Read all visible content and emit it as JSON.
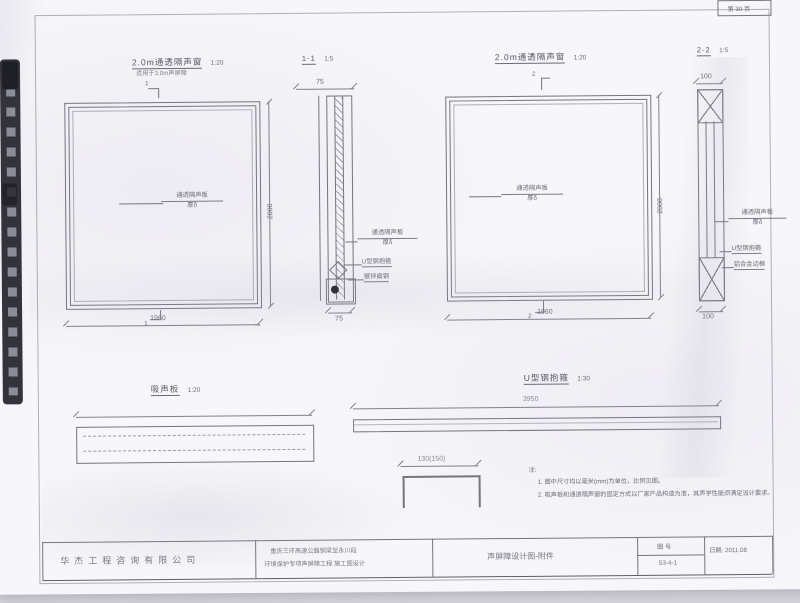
{
  "page": {
    "corner_label": "第 30 页"
  },
  "views": {
    "window_a": {
      "title": "2.0m通透隔声窗",
      "scale": "1:20",
      "subtitle": "适用于3.0m声屏障",
      "panel_label": "通透隔声板",
      "panel_thickness": "厚δ",
      "dim_width": "1960",
      "dim_height": "2000",
      "section_mark": "1"
    },
    "section_1_1": {
      "title": "1-1",
      "scale": "1:5",
      "dim_top": "75",
      "dim_bottom": "75",
      "labels": {
        "panel": "通透隔声板",
        "thickness": "厚δ",
        "clamp": "U型钢抱箍",
        "flat_steel": "镀锌扁钢"
      }
    },
    "window_b": {
      "title": "2.0m通透隔声窗",
      "scale": "1:20",
      "panel_label": "通透隔声板",
      "panel_thickness": "厚δ",
      "dim_width": "1960",
      "dim_height": "2000",
      "section_mark": "2"
    },
    "section_2_2": {
      "title": "2-2",
      "scale": "1:5",
      "dim_top": "100",
      "dim_bottom": "100",
      "labels": {
        "panel": "通透隔声板",
        "thickness": "厚δ",
        "clamp": "U型钢抱箍",
        "frame": "铝合金边框"
      }
    },
    "absorber": {
      "title": "吸声板",
      "scale": "1:20"
    },
    "clamp_view": {
      "title": "U型钢抱箍",
      "scale": "1:30",
      "dim_length": "3950",
      "dim_width": "130(150)"
    }
  },
  "notes": {
    "heading": "注:",
    "items": [
      "1. 图中尺寸均以毫米(mm)为单位，比例见图。",
      "2. 吸声板和通透隔声窗的固定方式以厂家产品构造为准，其声学性能须满足设计要求。"
    ]
  },
  "titleblock": {
    "company": "华杰工程咨询有限公司",
    "project_line1": "重庆三环高速公路铜梁至永川段",
    "project_line2": "环境保护专项声屏障工程  施工图设计",
    "drawing_title": "声屏障设计图-附件",
    "sheet_no_label": "图 号",
    "sheet_no": "S3-4-1",
    "date": "日期: 2011.08"
  }
}
